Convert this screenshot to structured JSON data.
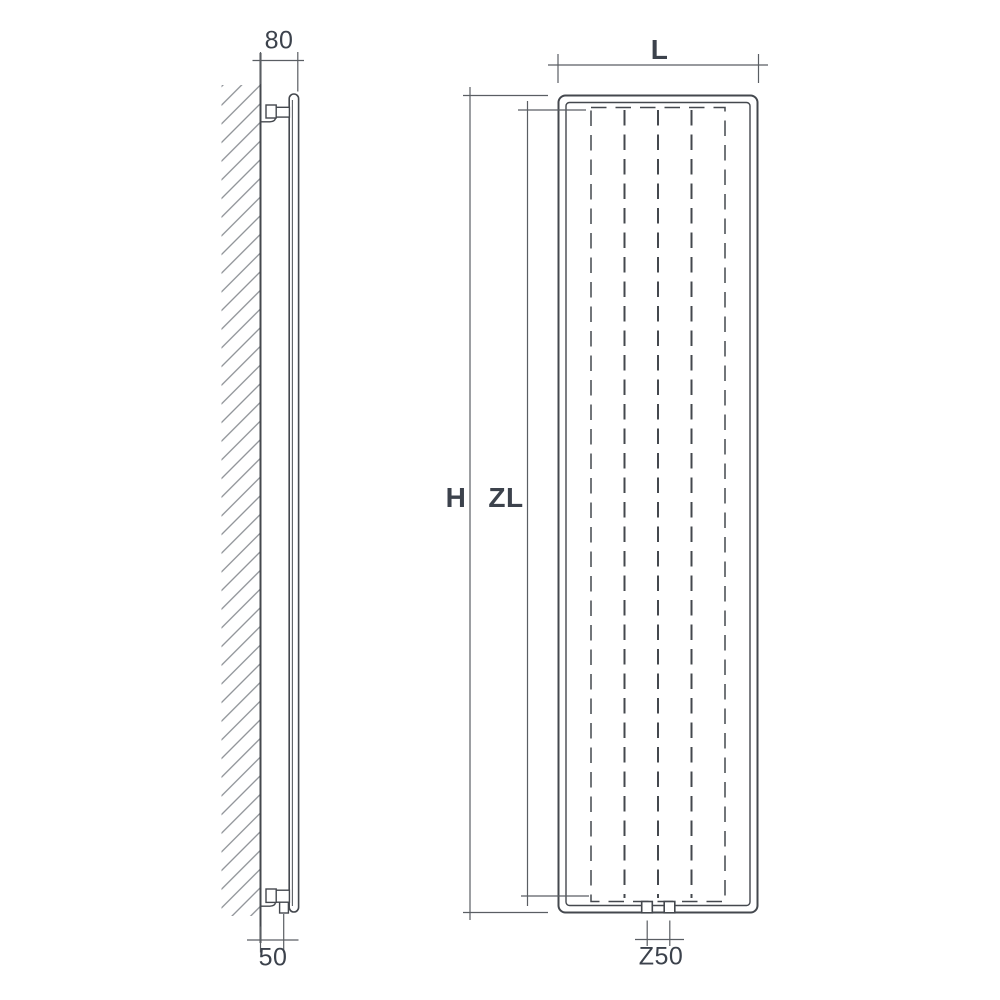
{
  "drawing": {
    "type": "radiator-technical-drawing",
    "background": "#ffffff",
    "colors": {
      "line": "#44484e",
      "line_light": "#5a5e63",
      "hatch": "#878b90",
      "text": "#3c424c",
      "background": "#ffffff"
    },
    "side_view": {
      "name": "wall-mounted side view",
      "dim_top_depth": "80",
      "dim_bottom_depth": "50"
    },
    "front_view": {
      "name": "front view",
      "dim_width": "L",
      "dim_height": "H",
      "dim_inner_height": "ZL",
      "dim_connection_spacing": "Z50",
      "fin_count": 5,
      "connection_count": 2
    }
  }
}
